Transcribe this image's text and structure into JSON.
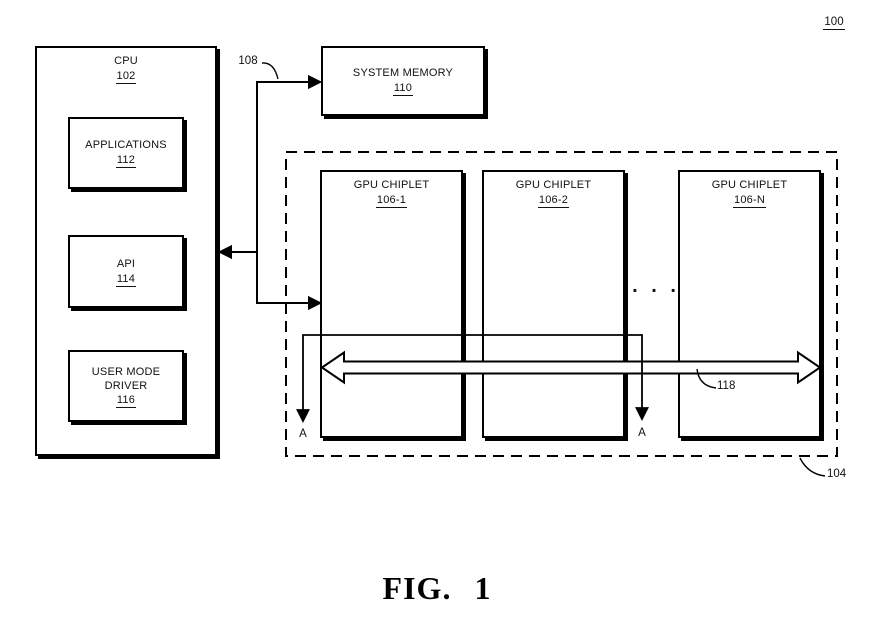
{
  "page_ref": "100",
  "cpu": {
    "title": "CPU",
    "ref": "102"
  },
  "applications": {
    "title": "APPLICATIONS",
    "ref": "112"
  },
  "api": {
    "title": "API",
    "ref": "114"
  },
  "user_mode_driver": {
    "line1": "USER MODE",
    "line2": "DRIVER",
    "ref": "116"
  },
  "system_memory": {
    "title": "SYSTEM MEMORY",
    "ref": "110"
  },
  "chiplets": {
    "c1": {
      "title": "GPU CHIPLET",
      "ref": "106-1"
    },
    "c2": {
      "title": "GPU CHIPLET",
      "ref": "106-2"
    },
    "cn": {
      "title": "GPU CHIPLET",
      "ref": "106-N"
    },
    "ellipsis": ". . .",
    "group_ref": "104"
  },
  "labels": {
    "bus_ref": "108",
    "crosslink_ref": "118"
  },
  "markers": {
    "left": "A",
    "right": "A"
  },
  "caption": "FIG. 1"
}
